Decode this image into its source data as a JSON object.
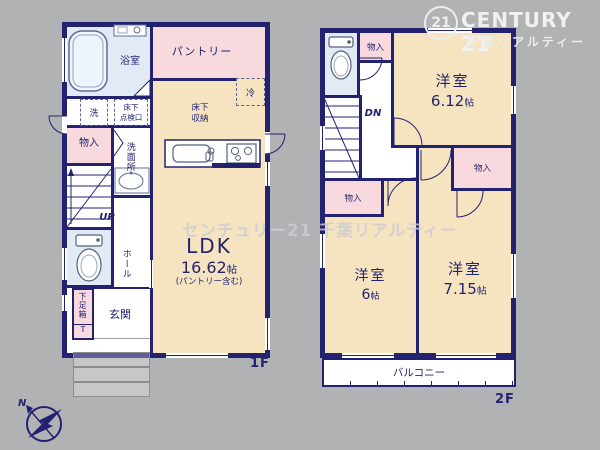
{
  "brand": {
    "seal": "21",
    "name": "CENTURY 21",
    "subname": "千葉リアルティー"
  },
  "watermark": "センチュリー21 千葉リアルティー",
  "compass": {
    "north": "N"
  },
  "floor1": {
    "label": "1F",
    "pantry": "パントリー",
    "bathroom": "浴室",
    "washer": "洗",
    "hatch_line1": "床下",
    "hatch_line2": "点検口",
    "storage": "物入",
    "washroom": "洗面所",
    "fridge": "冷",
    "underfloor_line1": "床下",
    "underfloor_line2": "収納",
    "up": "UP",
    "hall": "ホール",
    "shoebox": "下足箱",
    "shoebox_t": "T",
    "entrance": "玄関",
    "ldk_name": "LDK",
    "ldk_size": "16.62",
    "ldk_unit": "帖",
    "ldk_note": "(パントリー含む)"
  },
  "floor2": {
    "label": "2F",
    "storage_top": "物入",
    "storage_right": "物入",
    "storage_left": "物入",
    "room_a_name": "洋室",
    "room_a_size": "6.12",
    "room_a_unit": "帖",
    "room_b_name": "洋室",
    "room_b_size": "6",
    "room_b_unit": "帖",
    "room_c_name": "洋室",
    "room_c_size": "7.15",
    "room_c_unit": "帖",
    "dn": "DN",
    "balcony": "バルコニー"
  }
}
